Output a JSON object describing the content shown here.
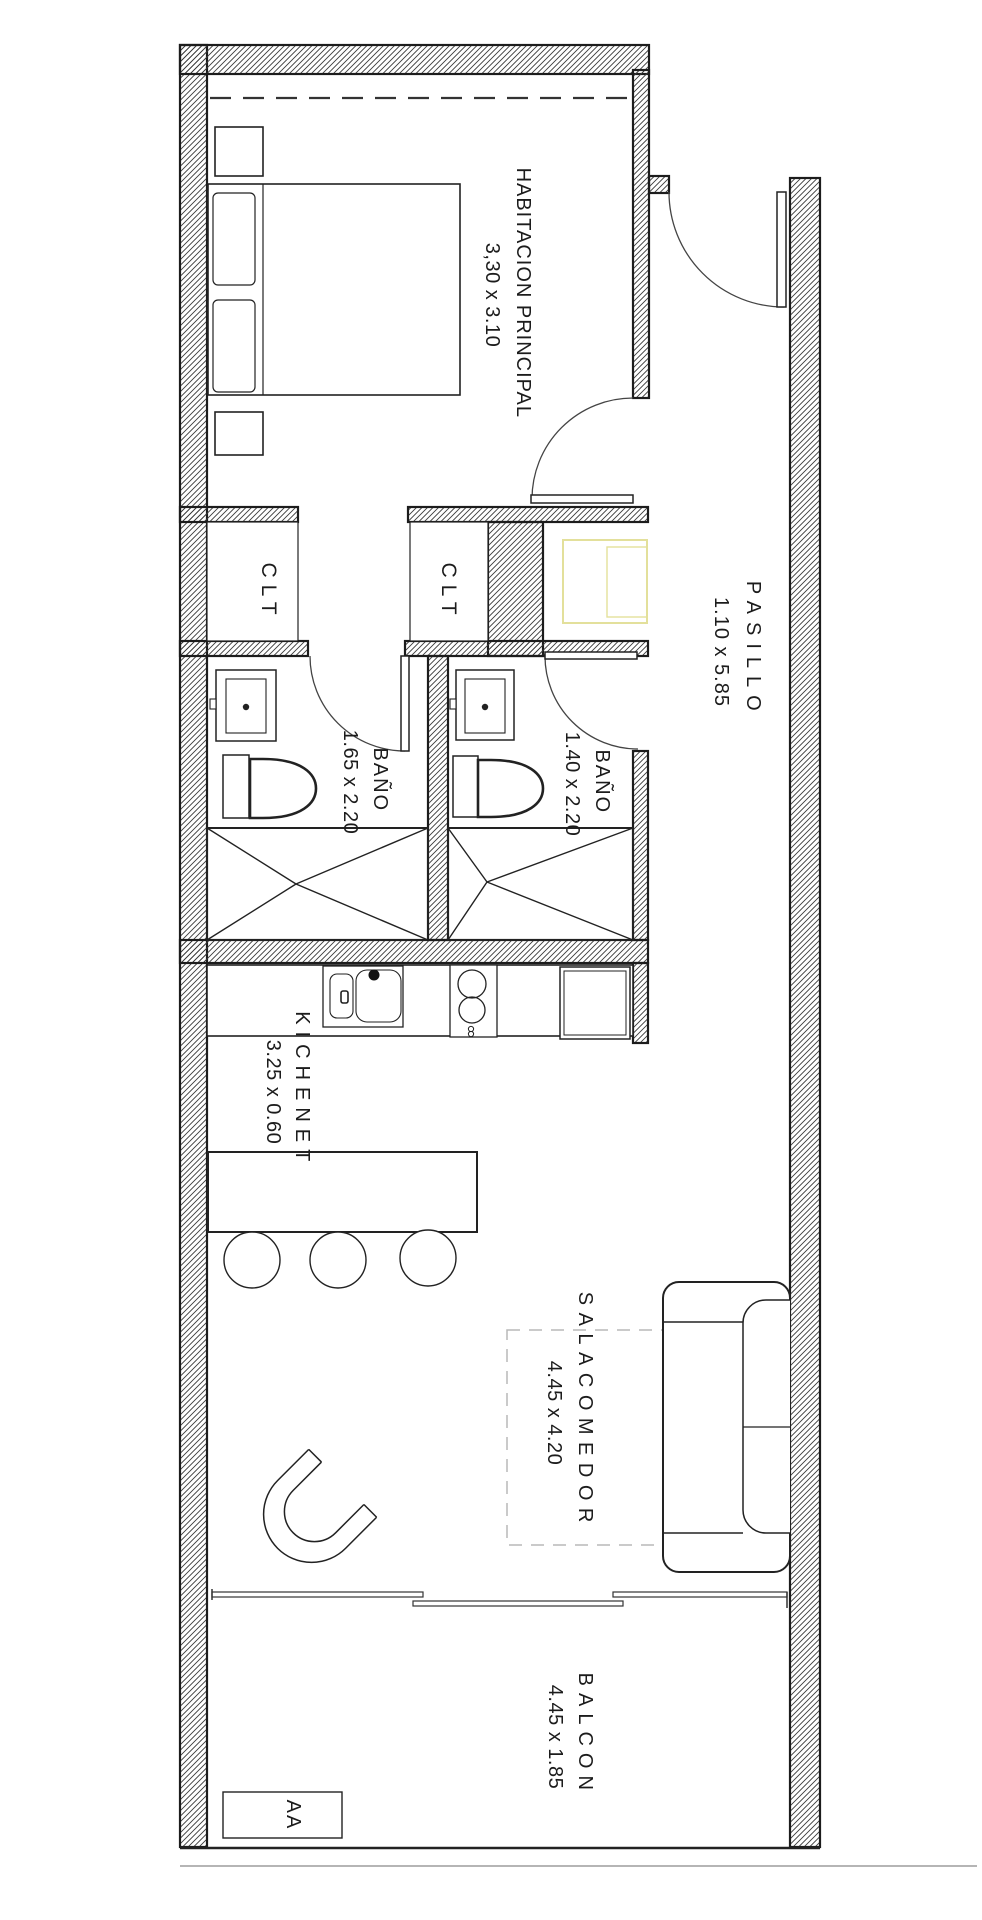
{
  "rooms": {
    "bedroom": {
      "name": "HABITACION PRINCIPAL",
      "dims": "3,30 x 3.10"
    },
    "hallway": {
      "name": "PASILLO",
      "dims": "1.10 x 5.85"
    },
    "bathroom1": {
      "name": "BAÑO",
      "dims": "1.65 x 2.20"
    },
    "bathroom2": {
      "name": "BAÑO",
      "dims": "1.40 x 2.20"
    },
    "kitchenette": {
      "name": "KICHENET",
      "dims": "3.25 x 0.60"
    },
    "living_dining": {
      "name": "SALACOMEDOR",
      "dims": "4.45 x 4.20"
    },
    "balcony": {
      "name": "BALCON",
      "dims": "4.45 x 1.85"
    }
  },
  "labels": {
    "closet1": "CLT",
    "closet2": "CLT",
    "ac_unit": "AA"
  },
  "colors": {
    "line": "#1c1c1c",
    "hatch": "#3a3a3a",
    "appliance_outline": "#e3e09b",
    "balcony_edge_gray": "#b5b5b5"
  }
}
